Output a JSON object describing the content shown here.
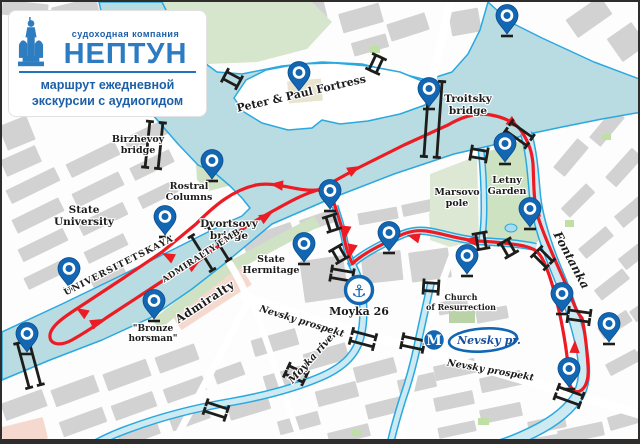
{
  "company_card": {
    "type_label": "судоходная компания",
    "name": "НЕПТУН",
    "tagline_line1": "маршрут ежедневной",
    "tagline_line2": "экскурсии с аудиогидом"
  },
  "map_labels": {
    "peter_paul": "Peter & Paul Fortress",
    "troitsky_1": "Troitsky",
    "troitsky_2": "bridge",
    "birzhevoy_1": "Birzhevoy",
    "birzhevoy_2": "bridge",
    "rostral_1": "Rostral",
    "rostral_2": "Columns",
    "state_university_1": "State",
    "state_university_2": "University",
    "dvortsovy_1": "Dvortsovy",
    "dvortsovy_2": "bridge",
    "universitetskaya": "UNIVERSITETSKAYA",
    "admiralty_emb": "ADMIRALTY EMB.",
    "admiralty": "Admiralty",
    "hermitage_1": "State",
    "hermitage_2": "Hermitage",
    "bronze_1": "\"Bronze",
    "bronze_2": "horsman\"",
    "marsovo_1": "Marsovo",
    "marsovo_2": "pole",
    "letny_1": "Letny",
    "letny_2": "Garden",
    "fontanka": "Fontanka",
    "moyka_river": "Moyka river",
    "nevsky_prospekt_west": "Nevsky prospekt",
    "nevsky_prospekt_east": "Nevsky prospekt",
    "church_1": "Church",
    "church_2": "of Resurrection"
  },
  "poi": {
    "dock_label": "Moyka 26",
    "anchor_icon": "⚓",
    "metro_letter": "M",
    "metro_station": "Nevsky pr."
  },
  "pins": [
    [
      297,
      72
    ],
    [
      505,
      15
    ],
    [
      427,
      88
    ],
    [
      210,
      160
    ],
    [
      163,
      216
    ],
    [
      328,
      190
    ],
    [
      302,
      243
    ],
    [
      387,
      232
    ],
    [
      465,
      255
    ],
    [
      528,
      208
    ],
    [
      503,
      143
    ],
    [
      67,
      268
    ],
    [
      25,
      333
    ],
    [
      152,
      300
    ],
    [
      560,
      293
    ],
    [
      607,
      323
    ],
    [
      567,
      368
    ]
  ],
  "colors": {
    "route_red": "#ed1c24",
    "pin_blue": "#1266b2",
    "water": "#b8dce1",
    "water_outline": "#2aa9e0",
    "river_fill": "#cdeaf2",
    "block_gray": "#d2d2d2",
    "park_green": "#d5e6cc",
    "logo_blue": "#2374bc"
  }
}
